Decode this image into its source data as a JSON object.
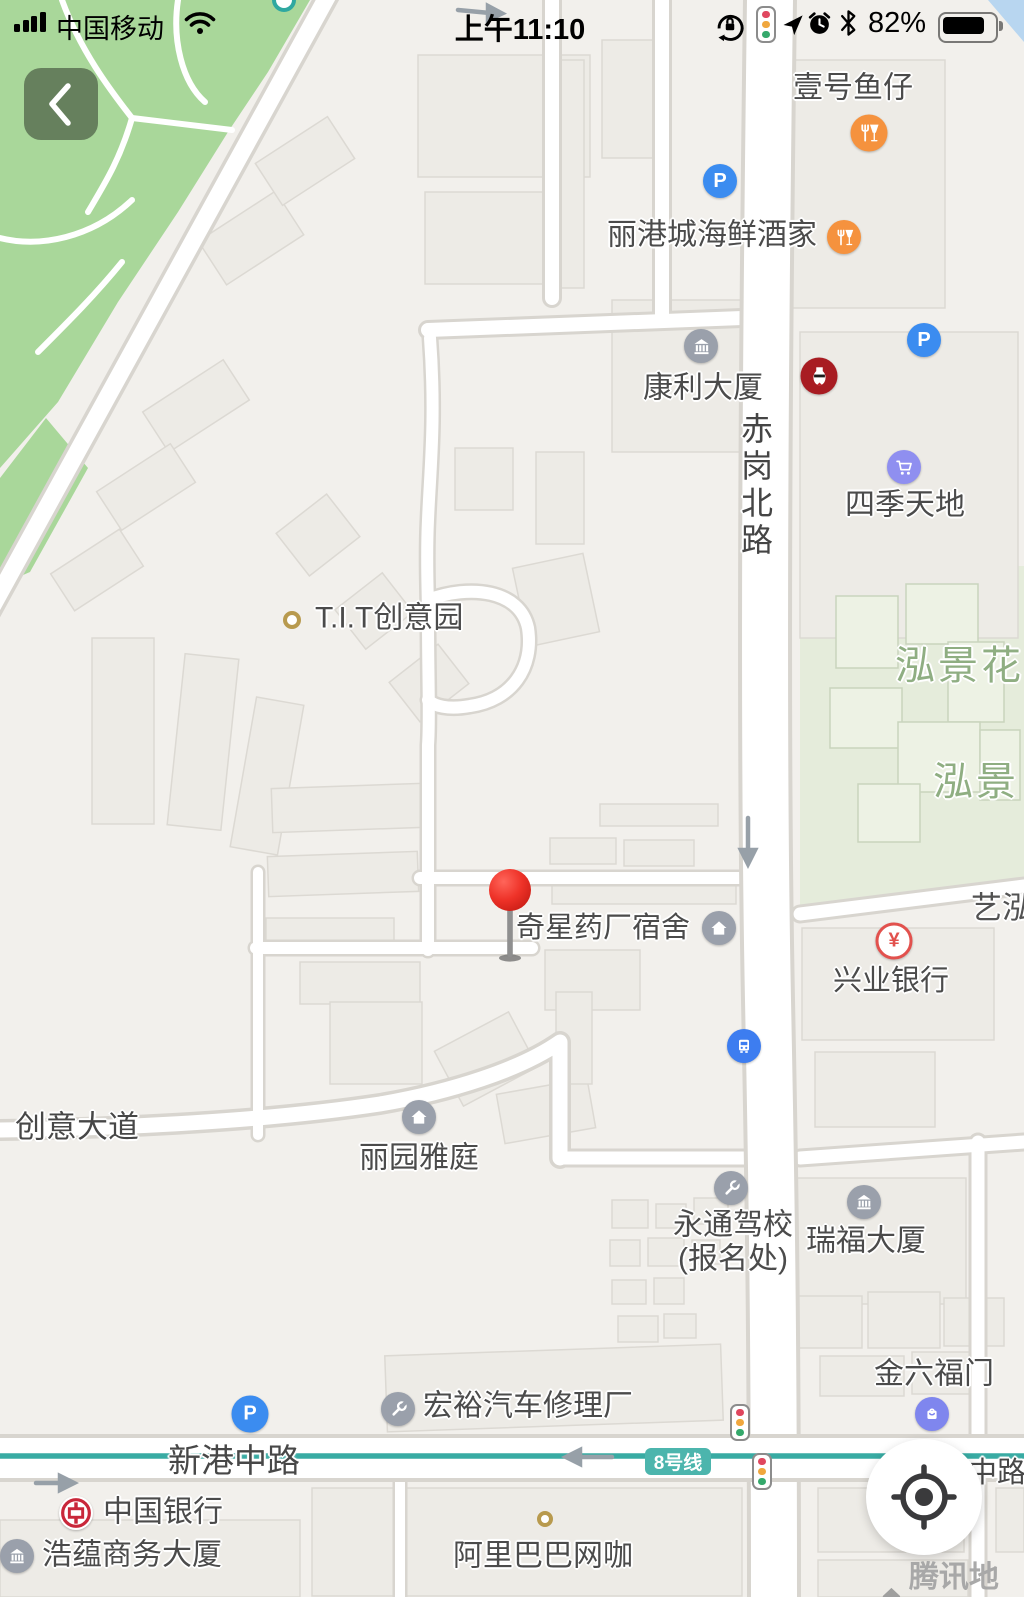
{
  "status_bar": {
    "carrier": "中国移动",
    "time": "上午11:10",
    "battery": "82%"
  },
  "map": {
    "road_labels": {
      "chigang_north": "赤岗北路",
      "xingang_middle_left": "新港中路",
      "xingang_middle_right": "中路",
      "chuangyi_avenue": "创意大道",
      "metro_badge": "8号线"
    },
    "area_labels": {
      "hongjing_1": "泓景花",
      "hongjing_2": "泓景",
      "yihong": "艺泓"
    },
    "pois": {
      "yihaoyuzai": "壹号鱼仔",
      "ligangcheng": "丽港城海鲜酒家",
      "kangli": "康利大厦",
      "sijitiandi": "四季天地",
      "tit": "T.I.T创意园",
      "qixing": "奇星药厂宿舍",
      "xingye_bank": "兴业银行",
      "liyuan": "丽园雅庭",
      "yongtong_line1": "永通驾校",
      "yongtong_line2": "(报名处)",
      "ruifu": "瑞福大厦",
      "jinliufu": "金六福门",
      "hongyu": "宏裕汽车修理厂",
      "boc": "中国银行",
      "haoyun": "浩蕴商务大厦",
      "alibaba": "阿里巴巴网咖"
    },
    "icon_glyphs": {
      "parking": "P",
      "yuan": "¥"
    }
  },
  "watermark": "腾讯地图"
}
